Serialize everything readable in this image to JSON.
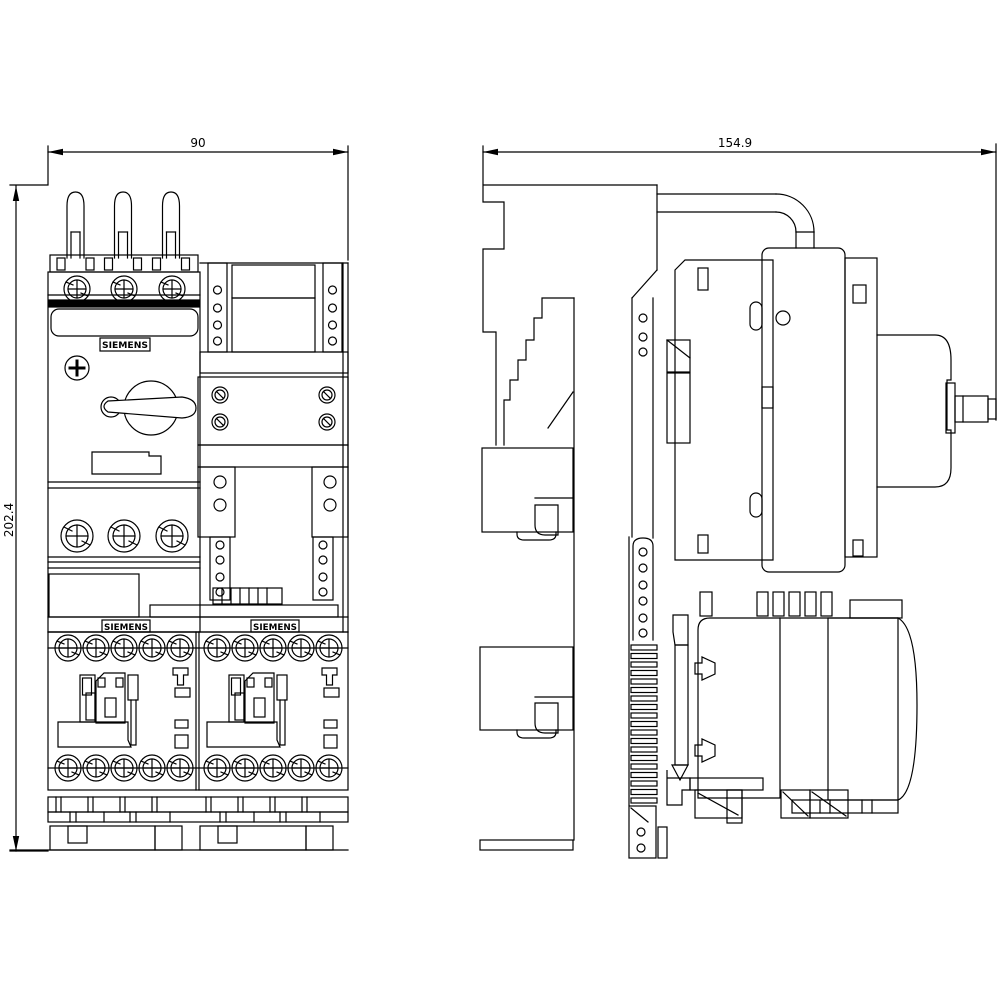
{
  "colors": {
    "line": "#000000",
    "background": "#ffffff",
    "fill": "#ffffff"
  },
  "dimensions": {
    "front_width": "90",
    "front_height": "202.4",
    "side_depth": "154.9"
  },
  "brand_labels": [
    "SIEMENS",
    "SIEMENS",
    "SIEMENS"
  ]
}
